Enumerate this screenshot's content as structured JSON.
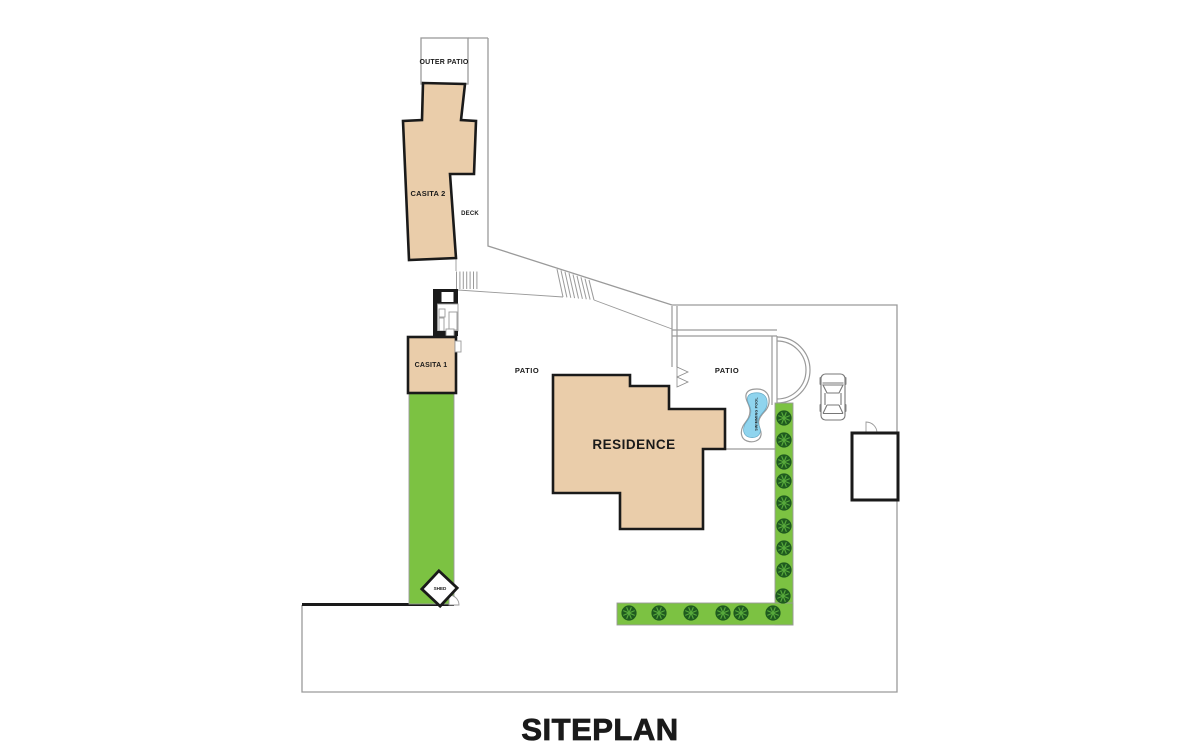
{
  "page": {
    "title": "SITEPLAN"
  },
  "labels": {
    "outer_patio": "OUTER PATIO",
    "casita_2": "CASITA 2",
    "deck": "DECK",
    "casita_1": "CASITA 1",
    "patio_left": "PATIO",
    "patio_right": "PATIO",
    "residence": "RESIDENCE",
    "shed": "SHED",
    "swimming_pool": "SWIMMING POOL"
  },
  "colors": {
    "building_fill": "#EACDAA",
    "building_stroke": "#1A1A1A",
    "line_gray": "#9A9A9A",
    "lawn_green": "#7CC242",
    "tree_dark_green": "#1F5B1F",
    "tree_light_green": "#57A93B",
    "pool_water": "#8FD4EE",
    "pool_edge": "#64A8C4",
    "pool_text": "#2A6080",
    "label_color": "#1A1A1A",
    "background": "#FFFFFF"
  }
}
